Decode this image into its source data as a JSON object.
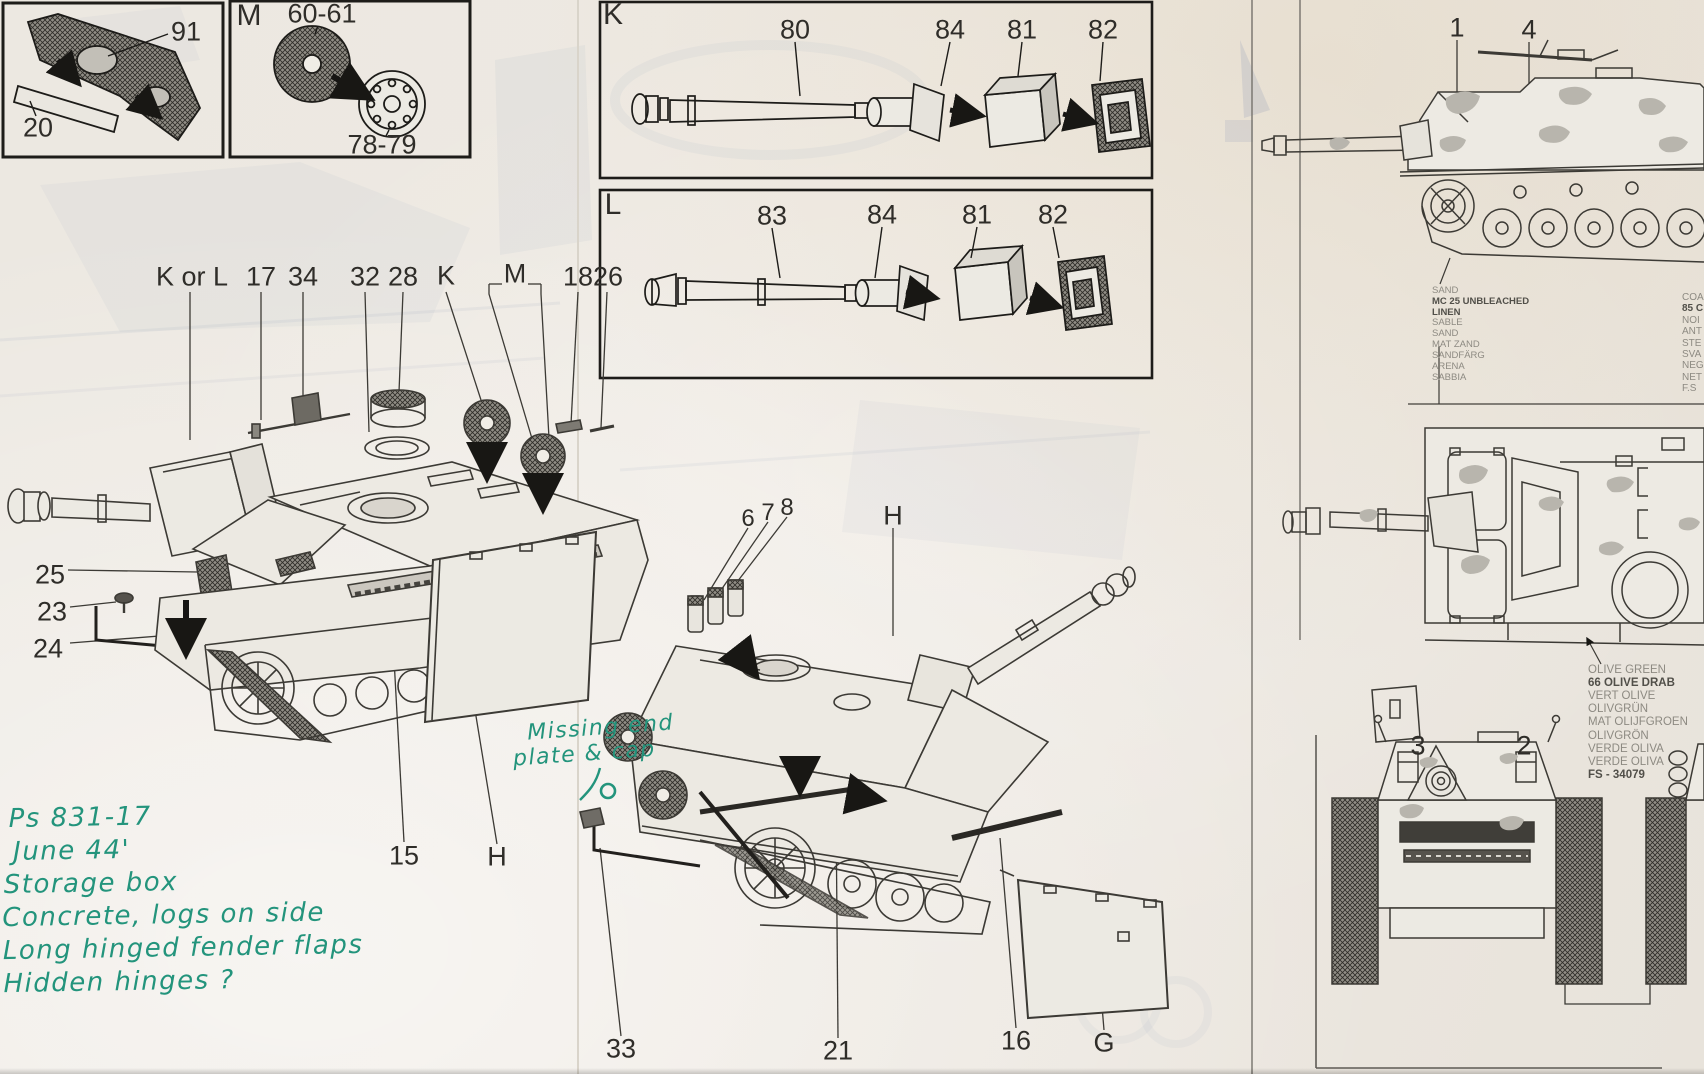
{
  "document": {
    "kind": "Scanned model-kit assembly instruction sheet with handwritten research notes",
    "subject": "StuG III assault gun plastic model"
  },
  "colors": {
    "paper": "#ece8e1",
    "ink": "#3a3833",
    "handwriting_green": "#23947c",
    "ghost_showthrough": "#a8b1c4"
  },
  "inset_fender": {
    "part_91": "91",
    "part_20": "20"
  },
  "inset_m": {
    "letter": "M",
    "part_top": "60-61",
    "part_bottom": "78-79"
  },
  "inset_k": {
    "letter": "K",
    "parts": [
      "80",
      "84",
      "81",
      "82"
    ]
  },
  "inset_l": {
    "letter": "L",
    "parts": [
      "83",
      "84",
      "81",
      "82"
    ]
  },
  "exploded_view_1": {
    "top_labels": [
      "K or L",
      "17",
      "34",
      "32",
      "28",
      "K",
      "M",
      "18",
      "26"
    ],
    "side_labels": [
      "25",
      "23",
      "24"
    ],
    "bottom_labels": [
      "15",
      "H"
    ]
  },
  "exploded_view_2": {
    "top_labels": [
      "6",
      "7",
      "8",
      "H"
    ],
    "bottom_labels": [
      "33",
      "21",
      "16",
      "G"
    ]
  },
  "paint_guide": {
    "side_view_labels": [
      "1",
      "4"
    ],
    "front_view_labels": [
      "3",
      "2"
    ],
    "sand_colors": {
      "lines": [
        "SAND",
        "MC 25 UNBLEACHED",
        "LINEN",
        "SABLE",
        "SAND",
        "MAT ZAND",
        "SANDFÄRG",
        "ARENA",
        "SABBIA"
      ]
    },
    "right_edge_colors_clipped": {
      "lines": [
        "COA",
        "85 C",
        "NOI",
        "ANT",
        "STE",
        "SVA",
        "NEG",
        "NET",
        "F.S"
      ]
    },
    "olive_colors": {
      "lines": [
        "OLIVE GREEN",
        "66 OLIVE DRAB",
        "VERT OLIVE",
        "OLIVGRÜN",
        "MAT OLIJFGROEN",
        "OLIVGRÖN",
        "VERDE OLIVA",
        "VERDE OLIVA",
        "FS - 34079"
      ]
    }
  },
  "handwritten_notes": {
    "note_missing_plate": {
      "line1": "Missing end",
      "line2": "plate & cap"
    },
    "note_reference": {
      "line1": "Ps 831-17",
      "line2": "June 44'",
      "line3": "Storage box",
      "line4": "Concrete, logs on side",
      "line5": "Long hinged fender flaps",
      "line6": "Hidden hinges ?"
    }
  }
}
